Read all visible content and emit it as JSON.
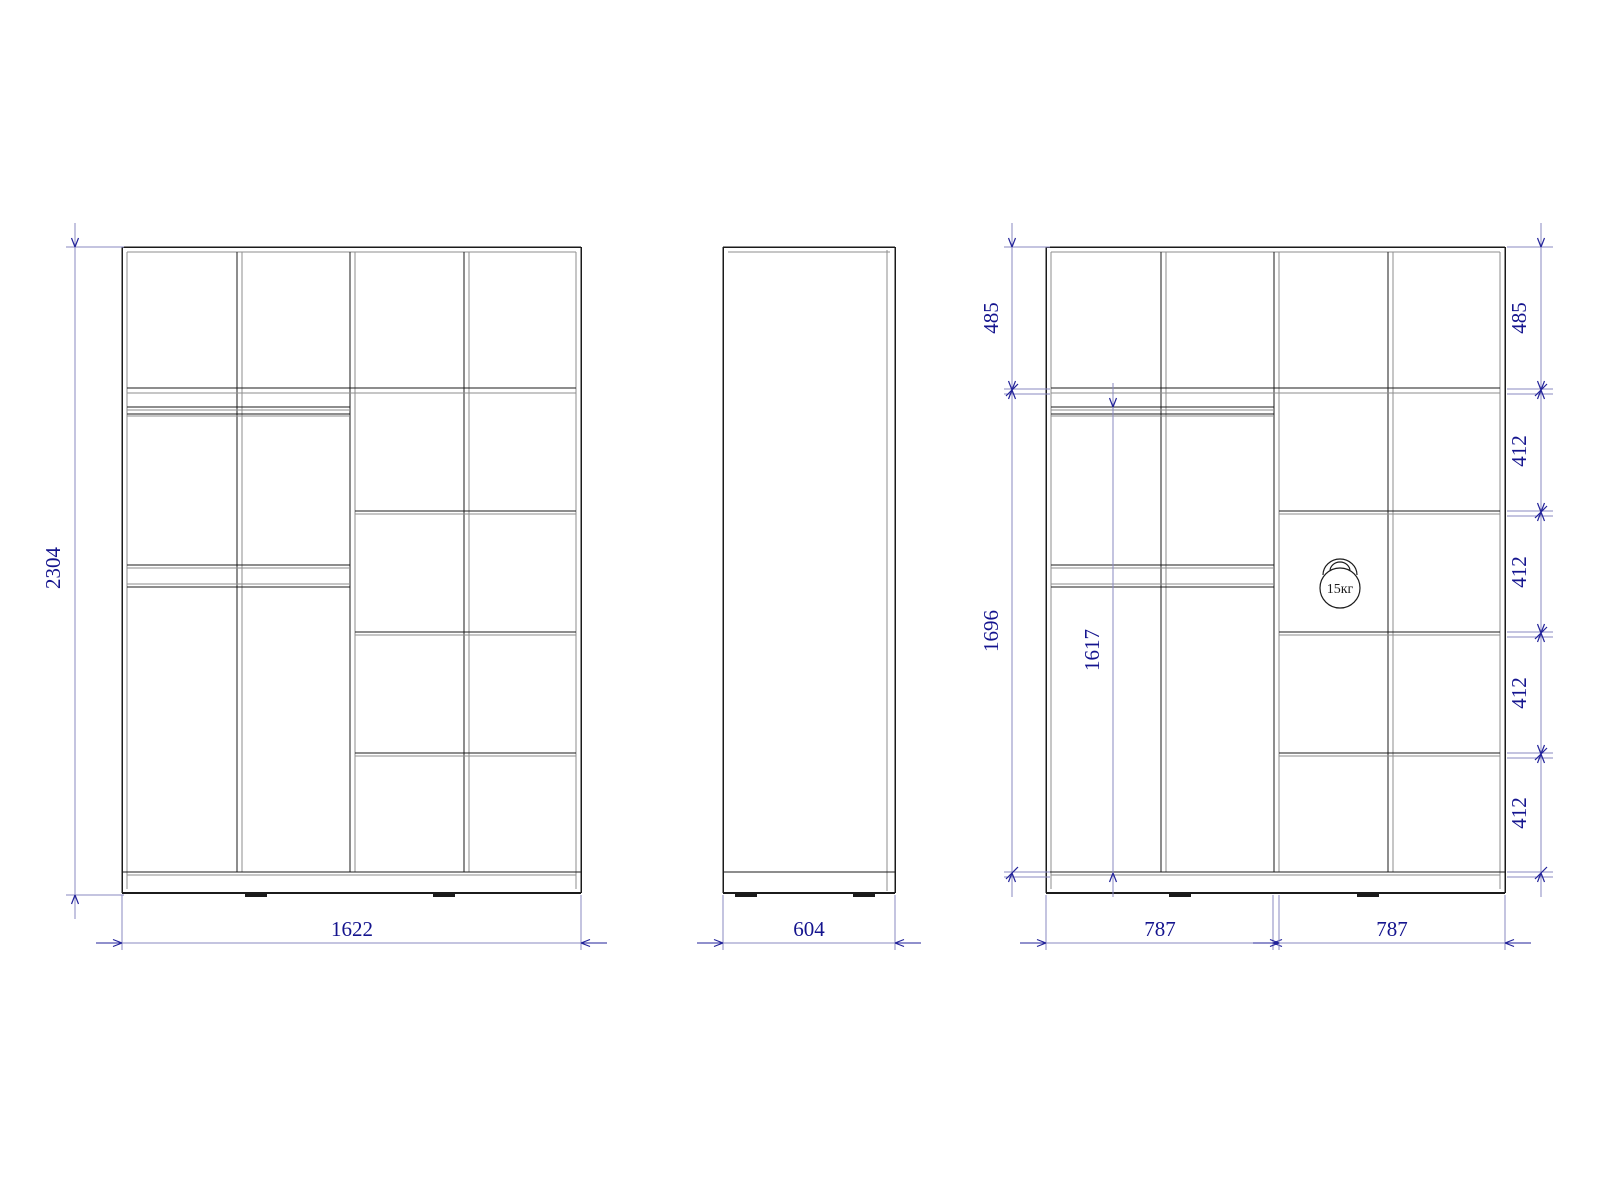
{
  "drawing_title": "wardrobe-three-view-technical-drawing",
  "colors": {
    "line": "#1b1b1b",
    "line_soft": "#8e8e8e",
    "dim_line": "#8a8ac2",
    "dim_accent": "#22229a",
    "dim_text": "#14148e",
    "background": "#ffffff"
  },
  "cabinet": {
    "cols_black": [
      122,
      237,
      350,
      464,
      576
    ],
    "line_gap": 5,
    "top": 247,
    "top_gray": 252,
    "shelfA": [
      388,
      393
    ],
    "rod": [
      407,
      410,
      414,
      416
    ],
    "band": [
      565,
      568,
      584,
      587
    ],
    "right_shelves": [
      [
        511,
        514
      ],
      [
        632,
        635
      ],
      [
        753,
        756
      ]
    ],
    "bottom_shelf": [
      872,
      875
    ],
    "bottom": 893,
    "feet": [
      [
        245,
        267
      ],
      [
        433,
        455
      ]
    ]
  },
  "views": {
    "front": {
      "name": "front-view",
      "dx": 0
    },
    "internal": {
      "name": "internal-view",
      "dx": 924
    },
    "side": {
      "name": "side-view",
      "left": 723,
      "right": 895,
      "top": 247,
      "bottom": 893,
      "inner_x": 887,
      "plinth_y": 872,
      "feet": [
        [
          735,
          757
        ],
        [
          853,
          875
        ]
      ]
    }
  },
  "h_dims": [
    {
      "id": "width-total",
      "label": "1622",
      "x1": 122,
      "x2": 581,
      "y": 943,
      "ext_top": 895,
      "text_x": 352
    },
    {
      "id": "depth",
      "label": "604",
      "x1": 723,
      "x2": 895,
      "y": 943,
      "ext_top": 895,
      "text_x": 809
    },
    {
      "id": "width-left-module",
      "label": "787",
      "x1": 1046,
      "x2": 1273,
      "y": 943,
      "ext_top": 895,
      "text_x": 1160
    },
    {
      "id": "width-right-module",
      "label": "787",
      "x1": 1279,
      "x2": 1505,
      "y": 943,
      "ext_top": 895,
      "text_x": 1392
    }
  ],
  "v_chains": [
    {
      "id": "height-total",
      "x": 75,
      "text_x": 60,
      "points": [
        247,
        895
      ],
      "ext": {
        "x1": 66,
        "x2": 124,
        "pairs": [
          [
            247
          ],
          [
            895
          ]
        ]
      },
      "labels": [
        {
          "text": "2304",
          "mid": 568
        }
      ]
    },
    {
      "id": "left-inner-chain",
      "x": 1012,
      "text_x": 998,
      "points": [
        247,
        390,
        873
      ],
      "ext": {
        "x1": 1004,
        "x2": 1050,
        "pairs": [
          [
            247
          ],
          [
            389,
            394
          ],
          [
            872,
            877
          ]
        ]
      },
      "labels": [
        {
          "text": "485",
          "mid": 318
        },
        {
          "text": "1696",
          "mid": 631
        }
      ]
    },
    {
      "id": "rod-height",
      "x": 1113,
      "text_x": 1099,
      "points": [
        407,
        873
      ],
      "ext": {
        "x1": 0,
        "x2": 0,
        "pairs": []
      },
      "labels": [
        {
          "text": "1617",
          "mid": 650
        }
      ]
    },
    {
      "id": "right-inner-chain",
      "x": 1541,
      "text_x": 1526,
      "points": [
        247,
        390,
        512,
        633,
        754,
        873
      ],
      "ext": {
        "x1": 1507,
        "x2": 1553,
        "pairs": [
          [
            247
          ],
          [
            389,
            394
          ],
          [
            511,
            516
          ],
          [
            632,
            637
          ],
          [
            753,
            758
          ],
          [
            872,
            877
          ]
        ]
      },
      "labels": [
        {
          "text": "485",
          "mid": 318
        },
        {
          "text": "412",
          "mid": 451
        },
        {
          "text": "412",
          "mid": 572
        },
        {
          "text": "412",
          "mid": 693
        },
        {
          "text": "412",
          "mid": 813
        }
      ]
    }
  ],
  "weight_badge": {
    "label": "15кг",
    "cx": 1340,
    "cy": 588,
    "r": 20
  }
}
